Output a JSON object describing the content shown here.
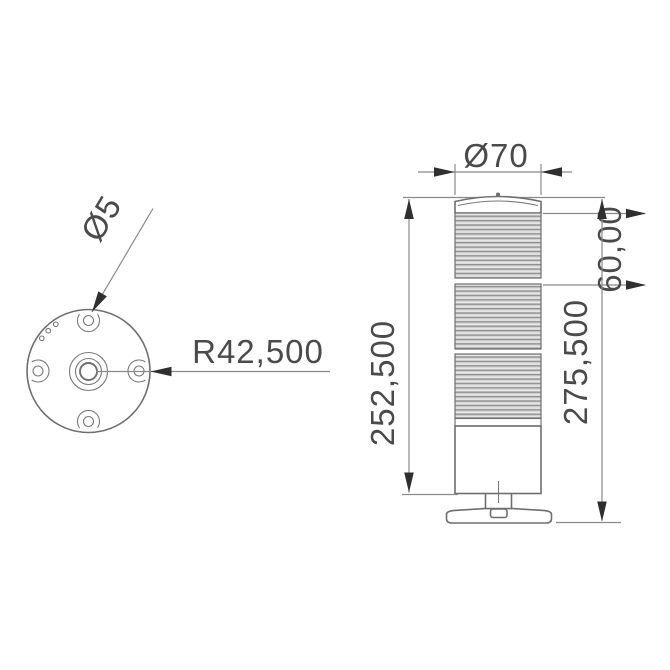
{
  "top_view": {
    "labels": {
      "hole_diameter": "Ø5",
      "mounting_radius": "R42,500"
    },
    "hole_count": 4
  },
  "front_view": {
    "labels": {
      "outer_diameter": "Ø70",
      "module_height": "60,00",
      "body_height": "252,500",
      "total_height": "275,500"
    },
    "module_count": 3
  },
  "colors": {
    "object_line": "#6e6e6e",
    "dimension_line": "#8a8a8a",
    "arrowhead": "#2f2f2f",
    "text": "#4a4a4a",
    "rib_light": "#d4d4d4",
    "rib_dark": "#8f8f8f",
    "background": "#ffffff"
  }
}
